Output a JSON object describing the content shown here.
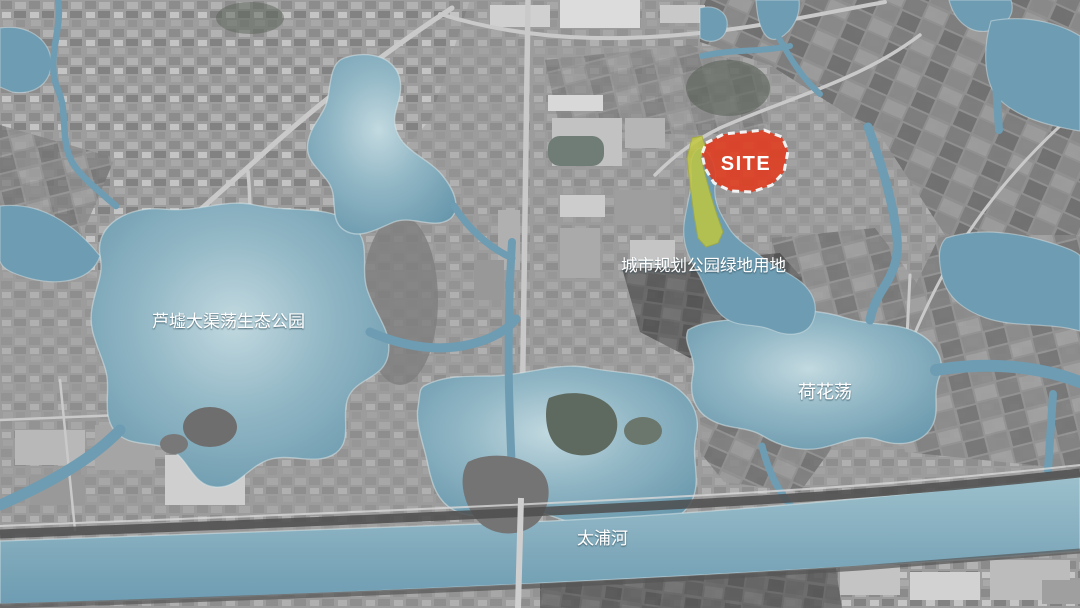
{
  "map": {
    "description": "aerial-site-location-map"
  },
  "annotations": {
    "site": {
      "label": "SITE",
      "fill": "#e23b1e",
      "border": "#ffffff",
      "border_style": "dashed"
    },
    "green_land": {
      "label": "城市规划公园绿地用地",
      "fill": "#c2c83e"
    },
    "places": [
      {
        "id": "luxu-daqudang-eco-park",
        "label": "芦墟大渠荡生态公园"
      },
      {
        "id": "hehua-dang-lake",
        "label": "荷花荡"
      },
      {
        "id": "taipu-river",
        "label": "太浦河"
      }
    ]
  },
  "colors": {
    "water": "#6e9cb2",
    "water_light": "#c2d9e0",
    "land": "#9a9a9a",
    "site_red": "#e23b1e",
    "green_land": "#c2c83e",
    "label_text": "#ffffff"
  }
}
